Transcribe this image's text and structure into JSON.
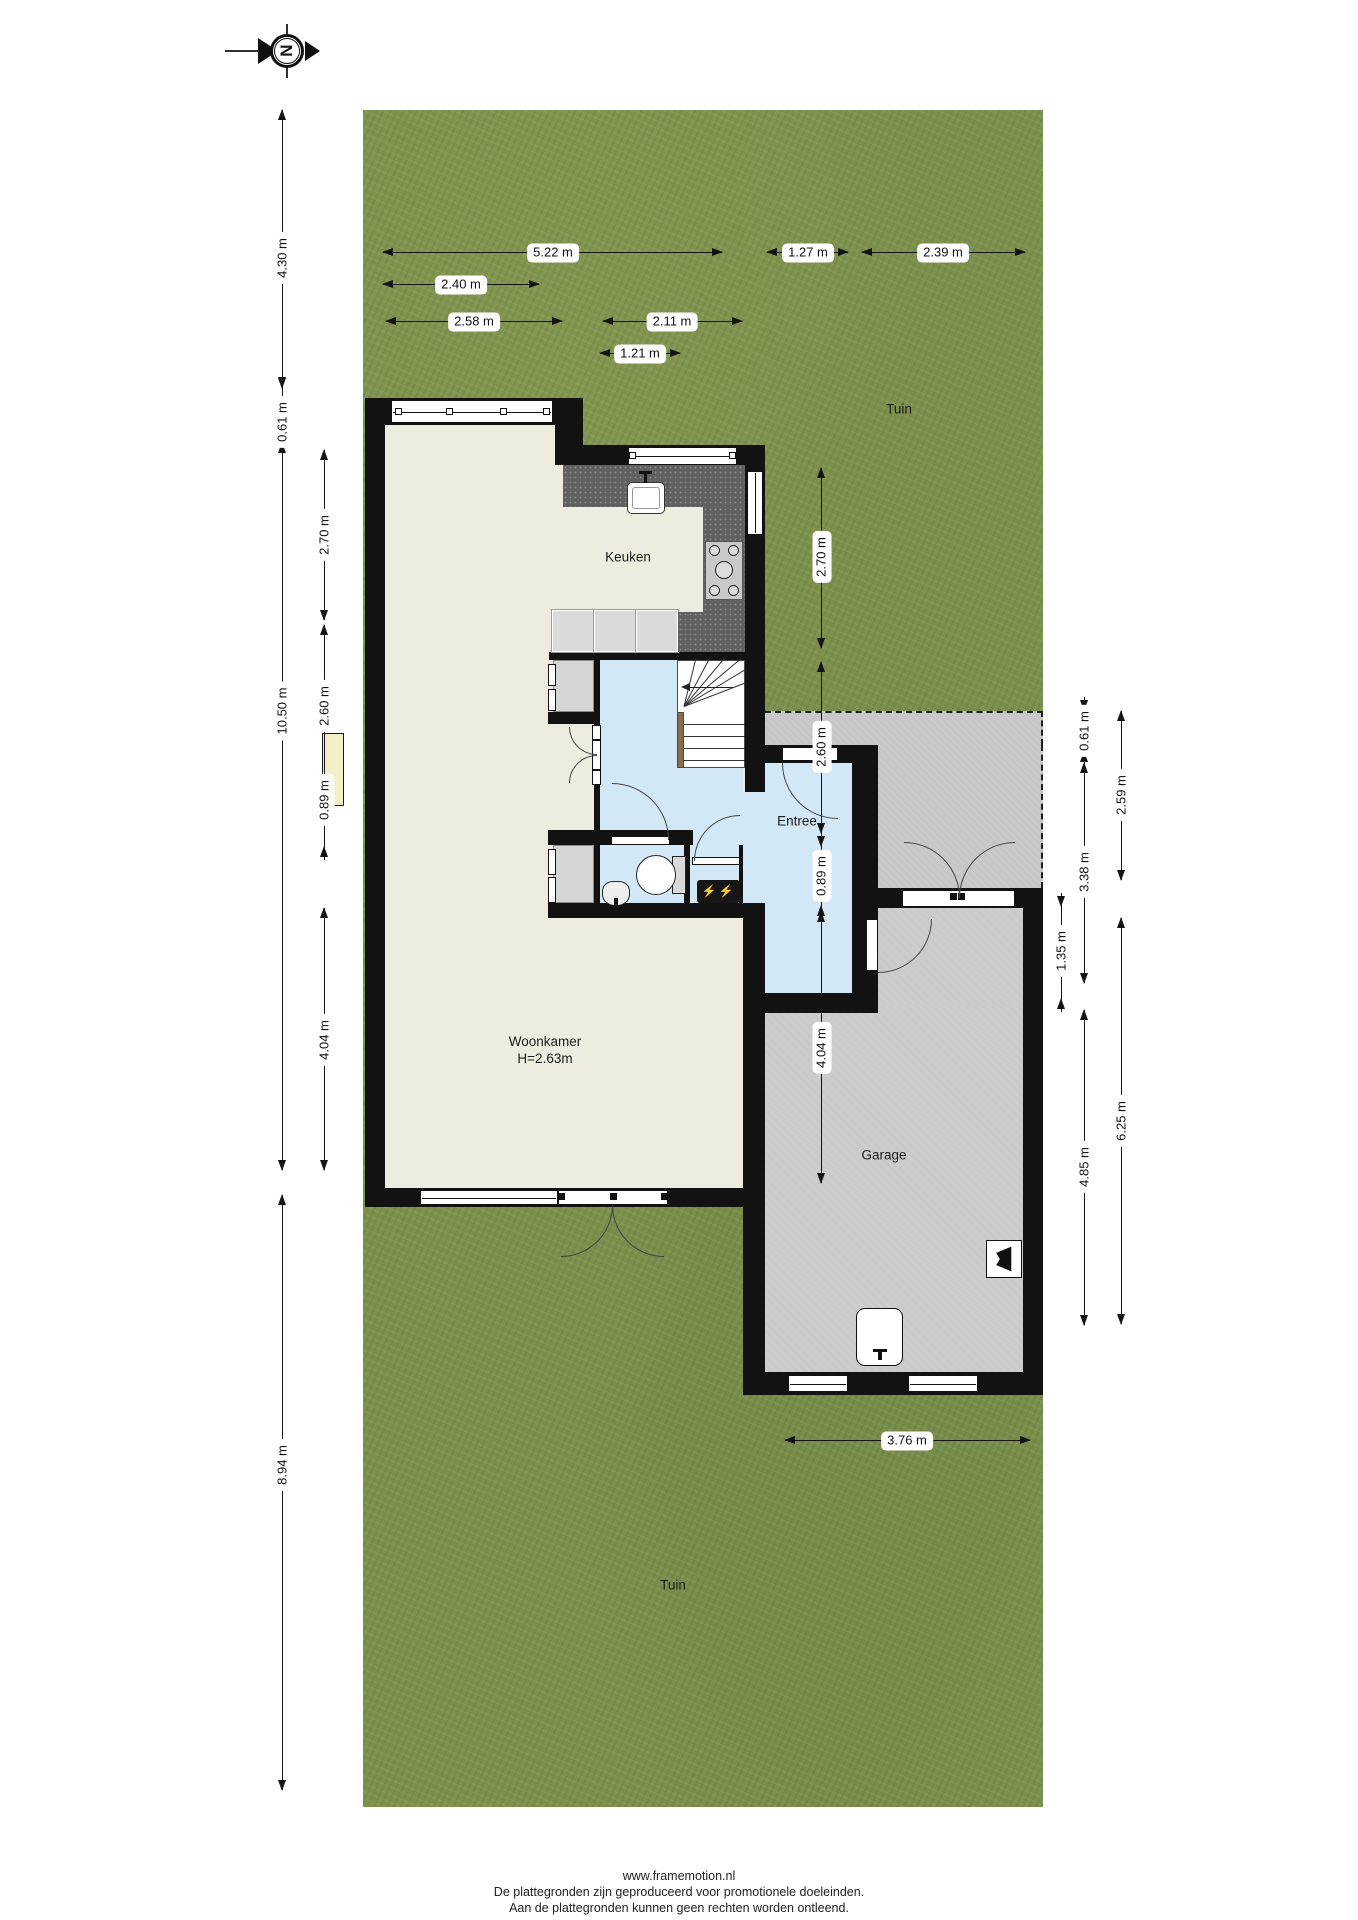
{
  "compass": {
    "north_letter": "N"
  },
  "rooms": {
    "tuin_top": "Tuin",
    "tuin_bottom": "Tuin",
    "keuken": "Keuken",
    "entree": "Entree",
    "woonkamer": "Woonkamer",
    "woonkamer_height": "H=2.63m",
    "garage": "Garage"
  },
  "dims": {
    "top_522": "5.22 m",
    "top_127": "1.27 m",
    "top_239": "2.39 m",
    "top_240": "2.40 m",
    "top_258": "2.58 m",
    "top_211": "2.11 m",
    "top_121": "1.21 m",
    "left_430": "4.30 m",
    "left_061": "0.61 m",
    "left_1050": "10.50 m",
    "left_894": "8.94 m",
    "left_270": "2.70 m",
    "left_260": "2.60 m",
    "left_089": "0.89 m",
    "left_404": "4.04 m",
    "right_270": "2.70 m",
    "right_260": "2.60 m",
    "right_089": "0.89 m",
    "right_404": "4.04 m",
    "right_061": "0.61 m",
    "right_338": "3.38 m",
    "right_135": "1.35 m",
    "right_485": "4.85 m",
    "right_259": "2.59 m",
    "right_625": "6.25 m",
    "bottom_376": "3.76 m"
  },
  "icons": {
    "fuse_bolts": "⚡⚡"
  },
  "footer": {
    "line1": "www.framemotion.nl",
    "line2": "De plattegronden zijn geproduceerd voor promotionele doeleinden.",
    "line3": "Aan de plattegronden kunnen geen rechten worden ontleend."
  },
  "colors": {
    "garden": "#7d914f",
    "paving": "#c6c6c6",
    "wall": "#121212",
    "floor_living": "#edecdf",
    "floor_entry": "#d2e8f7",
    "floor_garage": "#cacaca",
    "counter": "#606060",
    "cabinet": "#dadada",
    "closet": "#d5d5d5",
    "fireplace": "#f4eec6",
    "fuse_accent": "#ffd92b"
  }
}
